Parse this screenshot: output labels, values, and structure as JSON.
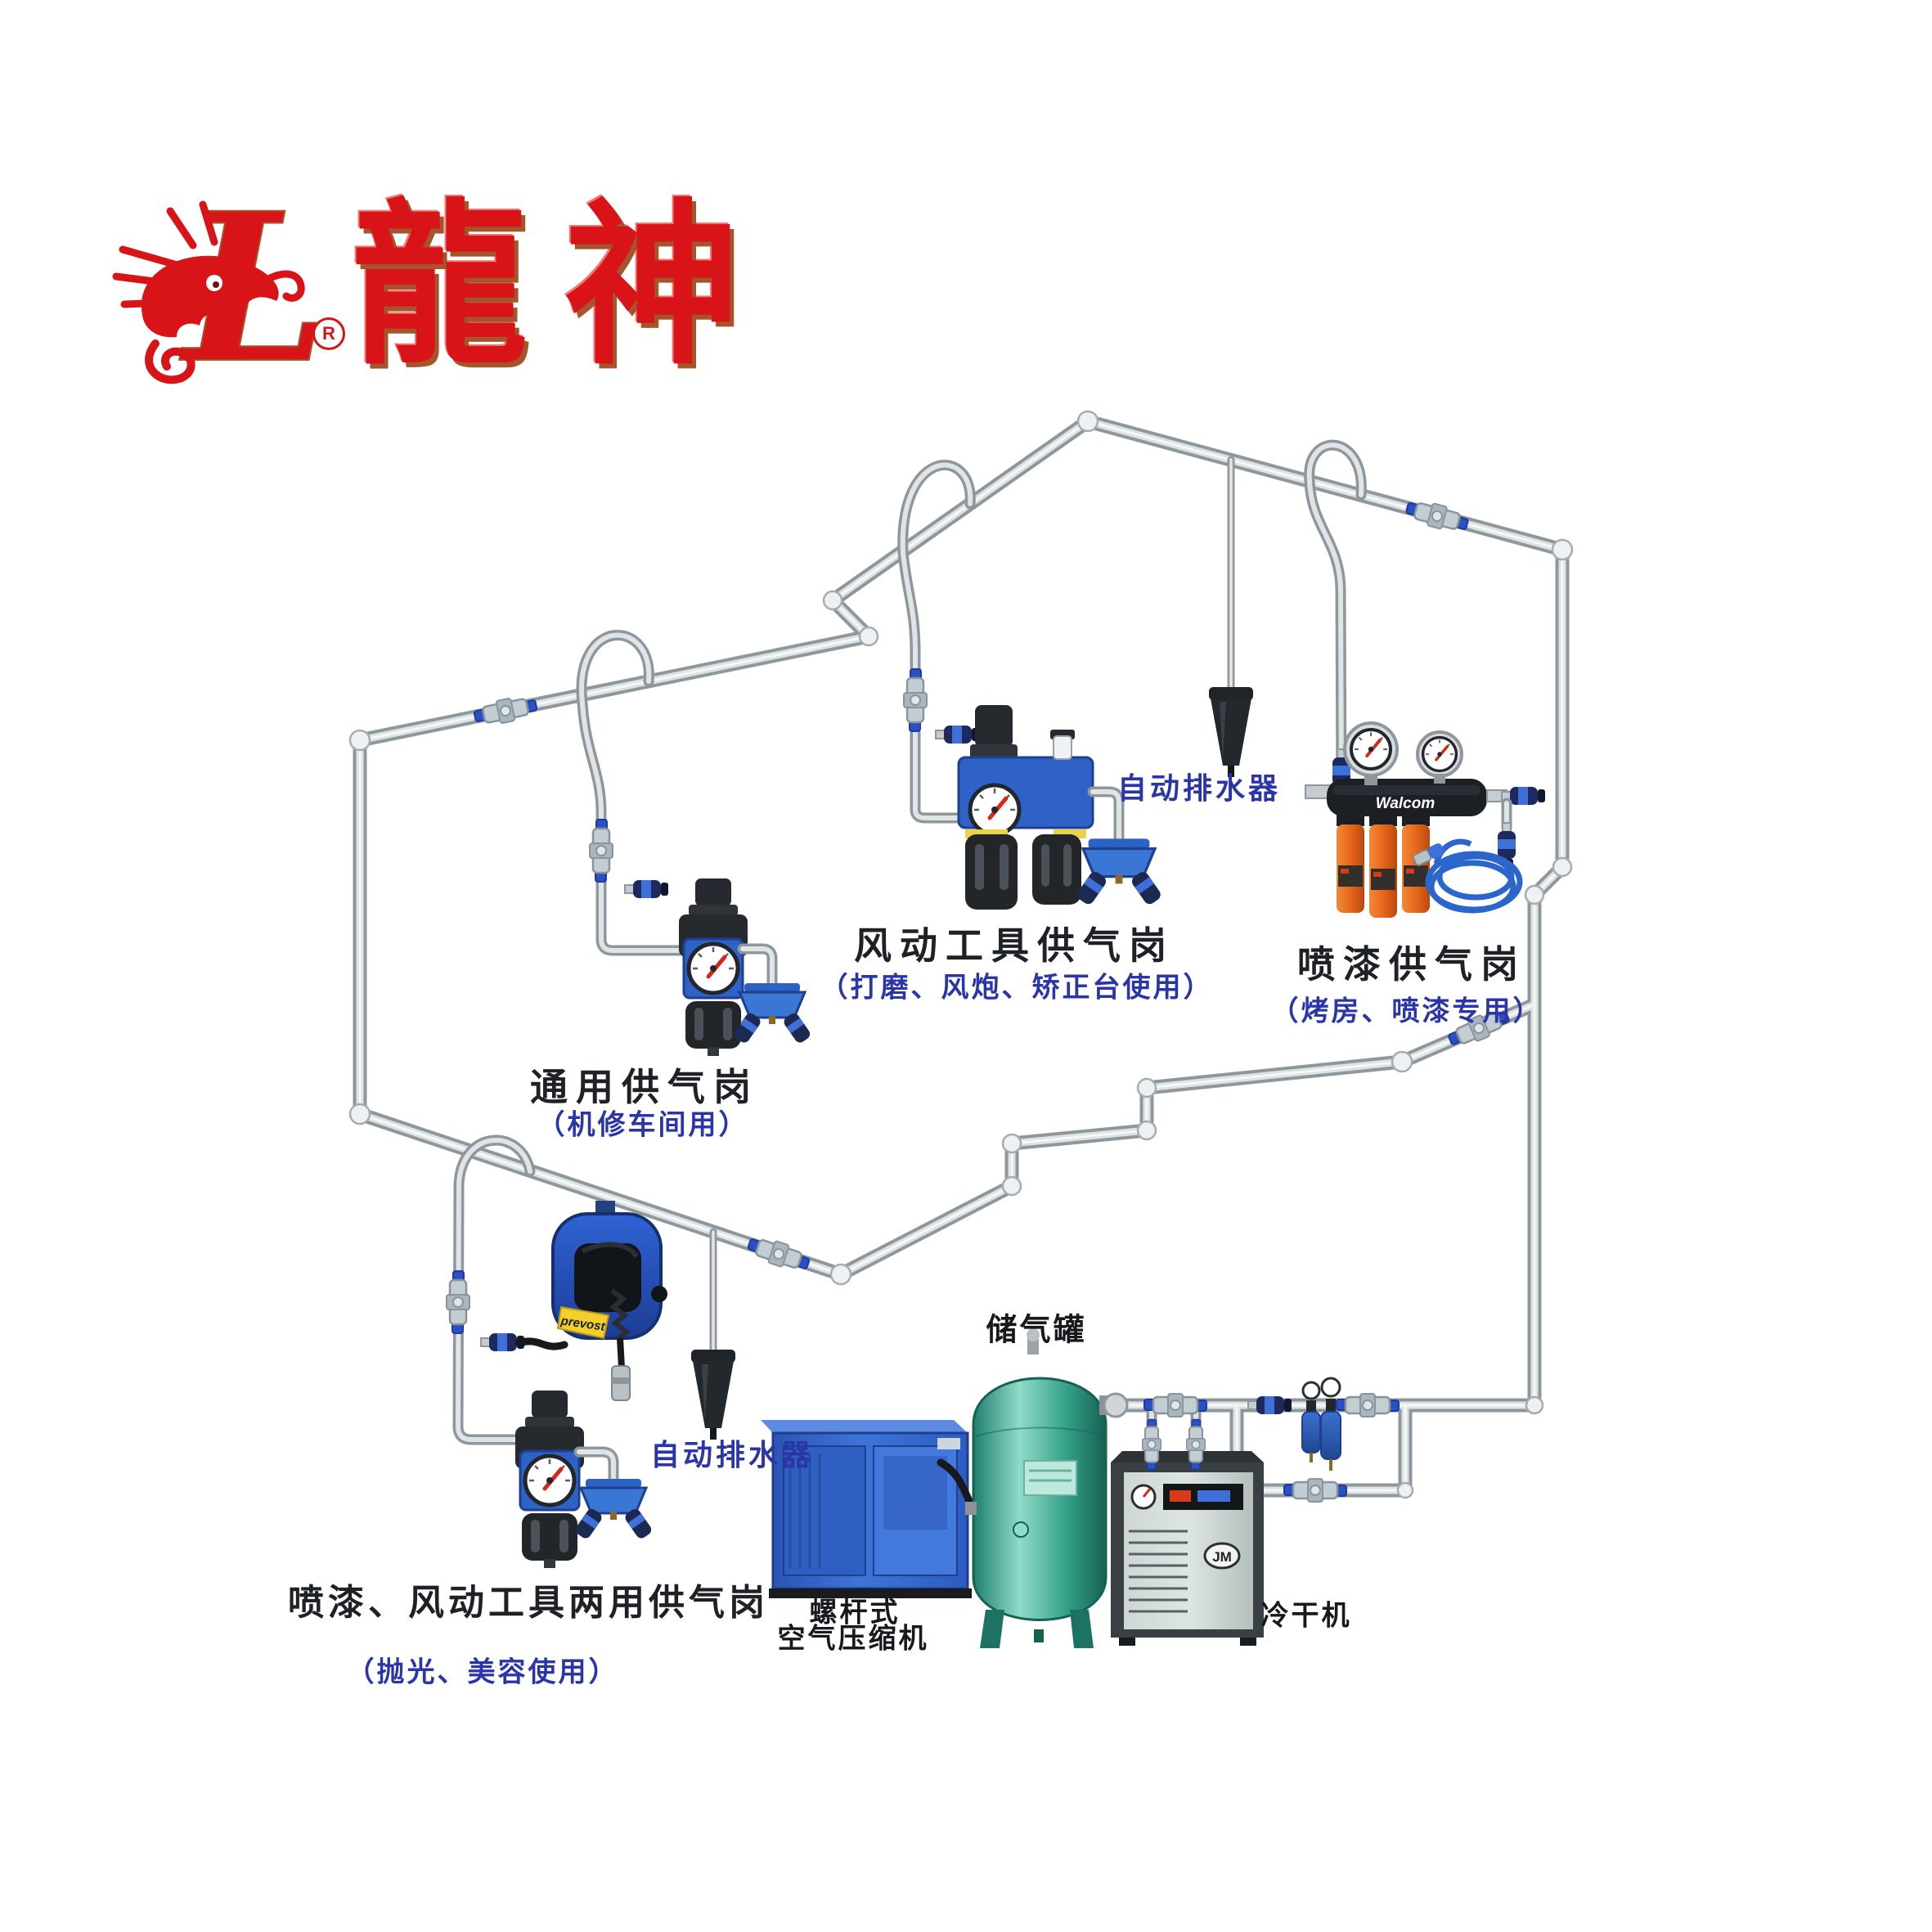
{
  "logo": {
    "brand_text": "龍神",
    "registered": "R"
  },
  "stations": {
    "general": {
      "title": "通用供气岗",
      "subtitle": "（机修车间用）"
    },
    "pneumatic": {
      "title": "风动工具供气岗",
      "subtitle": "（打磨、风炮、矫正台使用）"
    },
    "paint": {
      "title": "喷漆供气岗",
      "subtitle": "（烤房、喷漆专用）"
    },
    "dual": {
      "title": "喷漆、风动工具两用供气岗",
      "subtitle": "（抛光、美容使用）"
    }
  },
  "drains": {
    "top": "自动排水器",
    "bottom": "自动排水器"
  },
  "equipment": {
    "air_tank": "储气罐",
    "compressor_line1": "螺杆式",
    "compressor_line2": "空气压缩机",
    "dryer": "冷干机"
  },
  "brands": {
    "walcom": "Walcom",
    "prevost": "prevost",
    "dryer_logo": "JM"
  },
  "colors": {
    "brand_red": "#d81418",
    "label_blue": "#2a35a8",
    "pipe_silver": "#c9ced1",
    "tank_teal": "#2f9e85",
    "equipment_blue": "#3e74d8",
    "filter_orange": "#e8671c",
    "valve_lever_blue": "#2b50c5"
  }
}
